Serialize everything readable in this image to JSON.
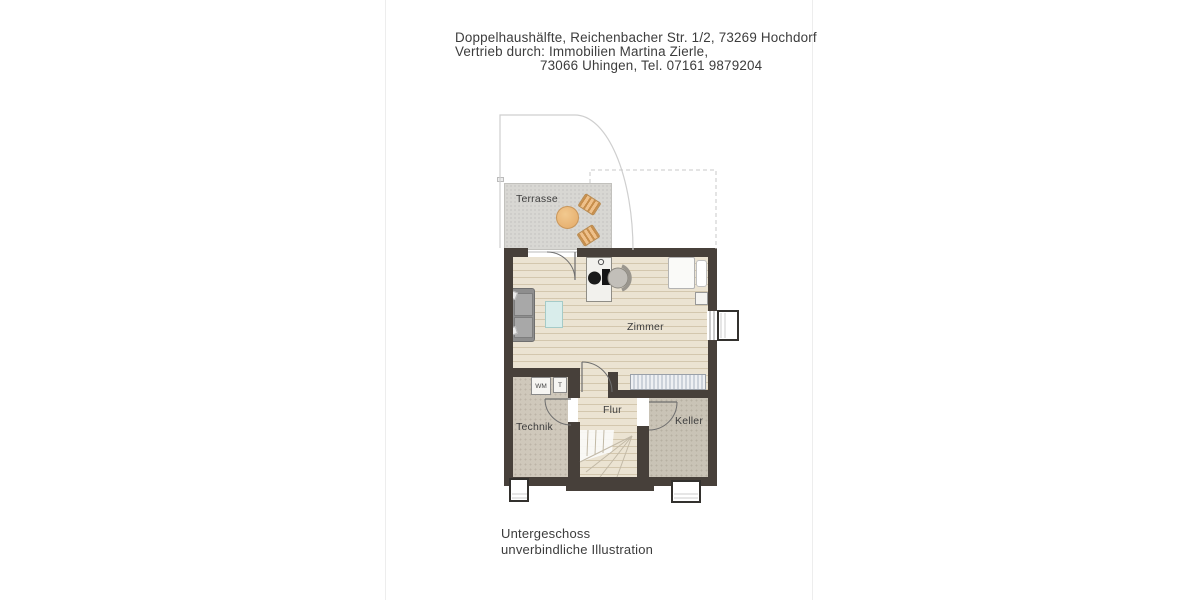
{
  "document": {
    "header": {
      "line1": "Doppelhaushälfte, Reichenbacher Str. 1/2, 73269 Hochdorf",
      "line2": "Vertrieb durch: Immobilien Martina Zierle,",
      "line3": "73066 Uhingen, Tel. 07161 9879204"
    },
    "footer": {
      "line1": "Untergeschoss",
      "line2": "unverbindliche Illustration"
    }
  },
  "plan": {
    "rooms": {
      "terrasse": "Terrasse",
      "zimmer": "Zimmer",
      "flur": "Flur",
      "technik": "Technik",
      "keller": "Keller"
    },
    "appliances": {
      "washing_machine": "WM",
      "dryer": "T"
    },
    "colors": {
      "wall": "#47403a",
      "zimmer_floor": "#ebe3d2",
      "technik_floor": "#cfc8bb",
      "keller_floor": "#c9c3b6",
      "terrace": "#d8d7d3",
      "terrace_furniture": "#e8b470",
      "coffee_table": "#d9edeb",
      "sofa": "#8e8e8e",
      "door_line": "#6e6e6e",
      "reference_outline": "#cfcfcf"
    }
  }
}
